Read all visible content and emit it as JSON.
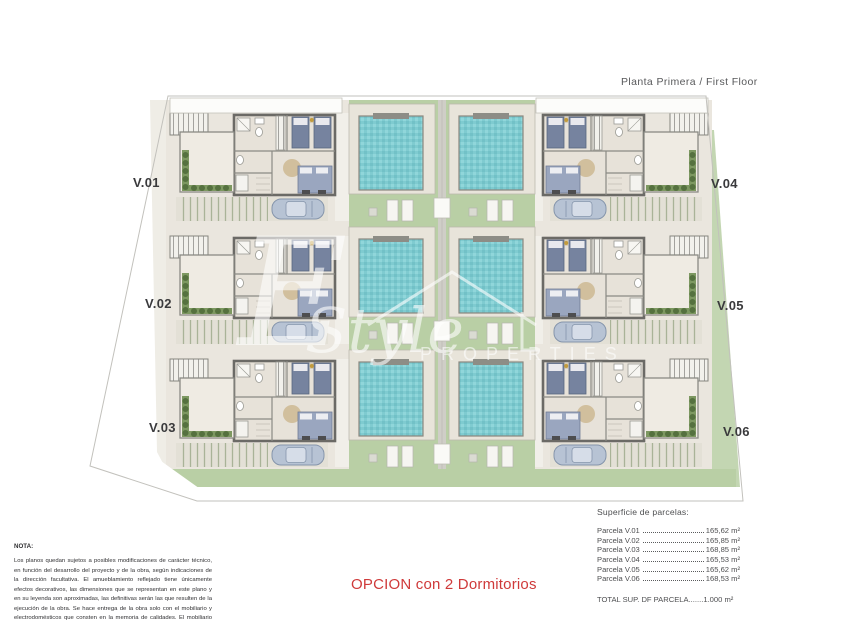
{
  "header": {
    "plan_title": "Planta Primera / First Floor"
  },
  "plan": {
    "unit_labels": [
      "V.01",
      "V.02",
      "V.03",
      "V.04",
      "V.05",
      "V.06"
    ]
  },
  "watermark": {
    "script_initial": "E",
    "script_word": "Style",
    "word": "PROPERTIES"
  },
  "note": {
    "title": "NOTA:",
    "body": "Los planos quedan sujetos a posibles modificaciones de carácter técnico, en función del desarrollo del proyecto y de la obra, según indicaciones de la dirección facultativa. El amueblamiento reflejado tiene únicamente efectos decorativos, las dimensiones que se representan en este plano y en su leyenda son aproximadas, las definitivas serán las que resulten de la ejecución de la obra. Se hace entrega de la obra solo con el mobiliario y electrodomésticos que consten en la memoria de calidades. El mobiliario de la cocina y la disposición de los sanitarios puede sufrir ligeras variaciones en función del montaje definitivo."
  },
  "option_label": "OPCION con 2 Dormitorios",
  "areas": {
    "title": "Superficie de parcelas:",
    "rows": [
      {
        "label": "Parcela V.01",
        "value": "165,62 m²"
      },
      {
        "label": "Parcela V.02",
        "value": "165,85 m²"
      },
      {
        "label": "Parcela V.03",
        "value": "168,85 m²"
      },
      {
        "label": "Parcela V.04",
        "value": "165,53 m²"
      },
      {
        "label": "Parcela V.05",
        "value": "165,62 m²"
      },
      {
        "label": "Parcela V.06",
        "value": "168,53 m²"
      }
    ],
    "total": "TOTAL SUP. DF PARCELA.......1.000 m²"
  },
  "colors": {
    "pool": "#7fcbd0",
    "lawn": "#b9cfa5",
    "terrace": "#e8e4da",
    "wall": "#6b6a66",
    "accent_red": "#cf3a3a"
  }
}
